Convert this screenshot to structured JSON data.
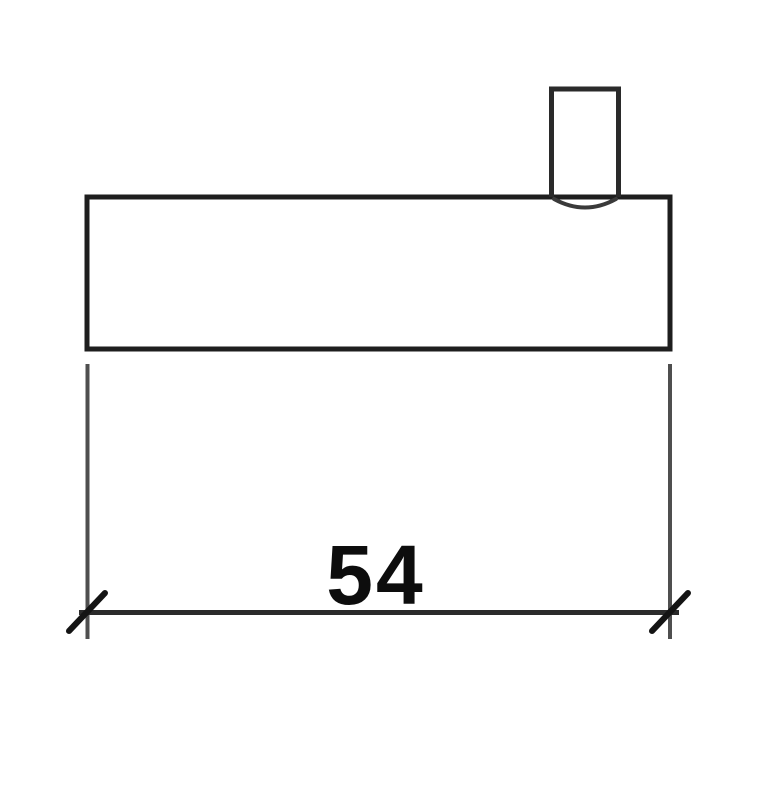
{
  "drawing": {
    "kind": "technical-dimension-drawing",
    "dimension": {
      "label": "54"
    },
    "colors": {
      "background": "#ffffff",
      "outline": "#1e1e1e",
      "tab_outline": "#2a2a2a",
      "arc": "#3a3a3a",
      "extension_line": "#4f4f4f",
      "dimension_line": "#2b2b2b",
      "tick": "#141414",
      "label_text": "#0d0d0d"
    }
  }
}
